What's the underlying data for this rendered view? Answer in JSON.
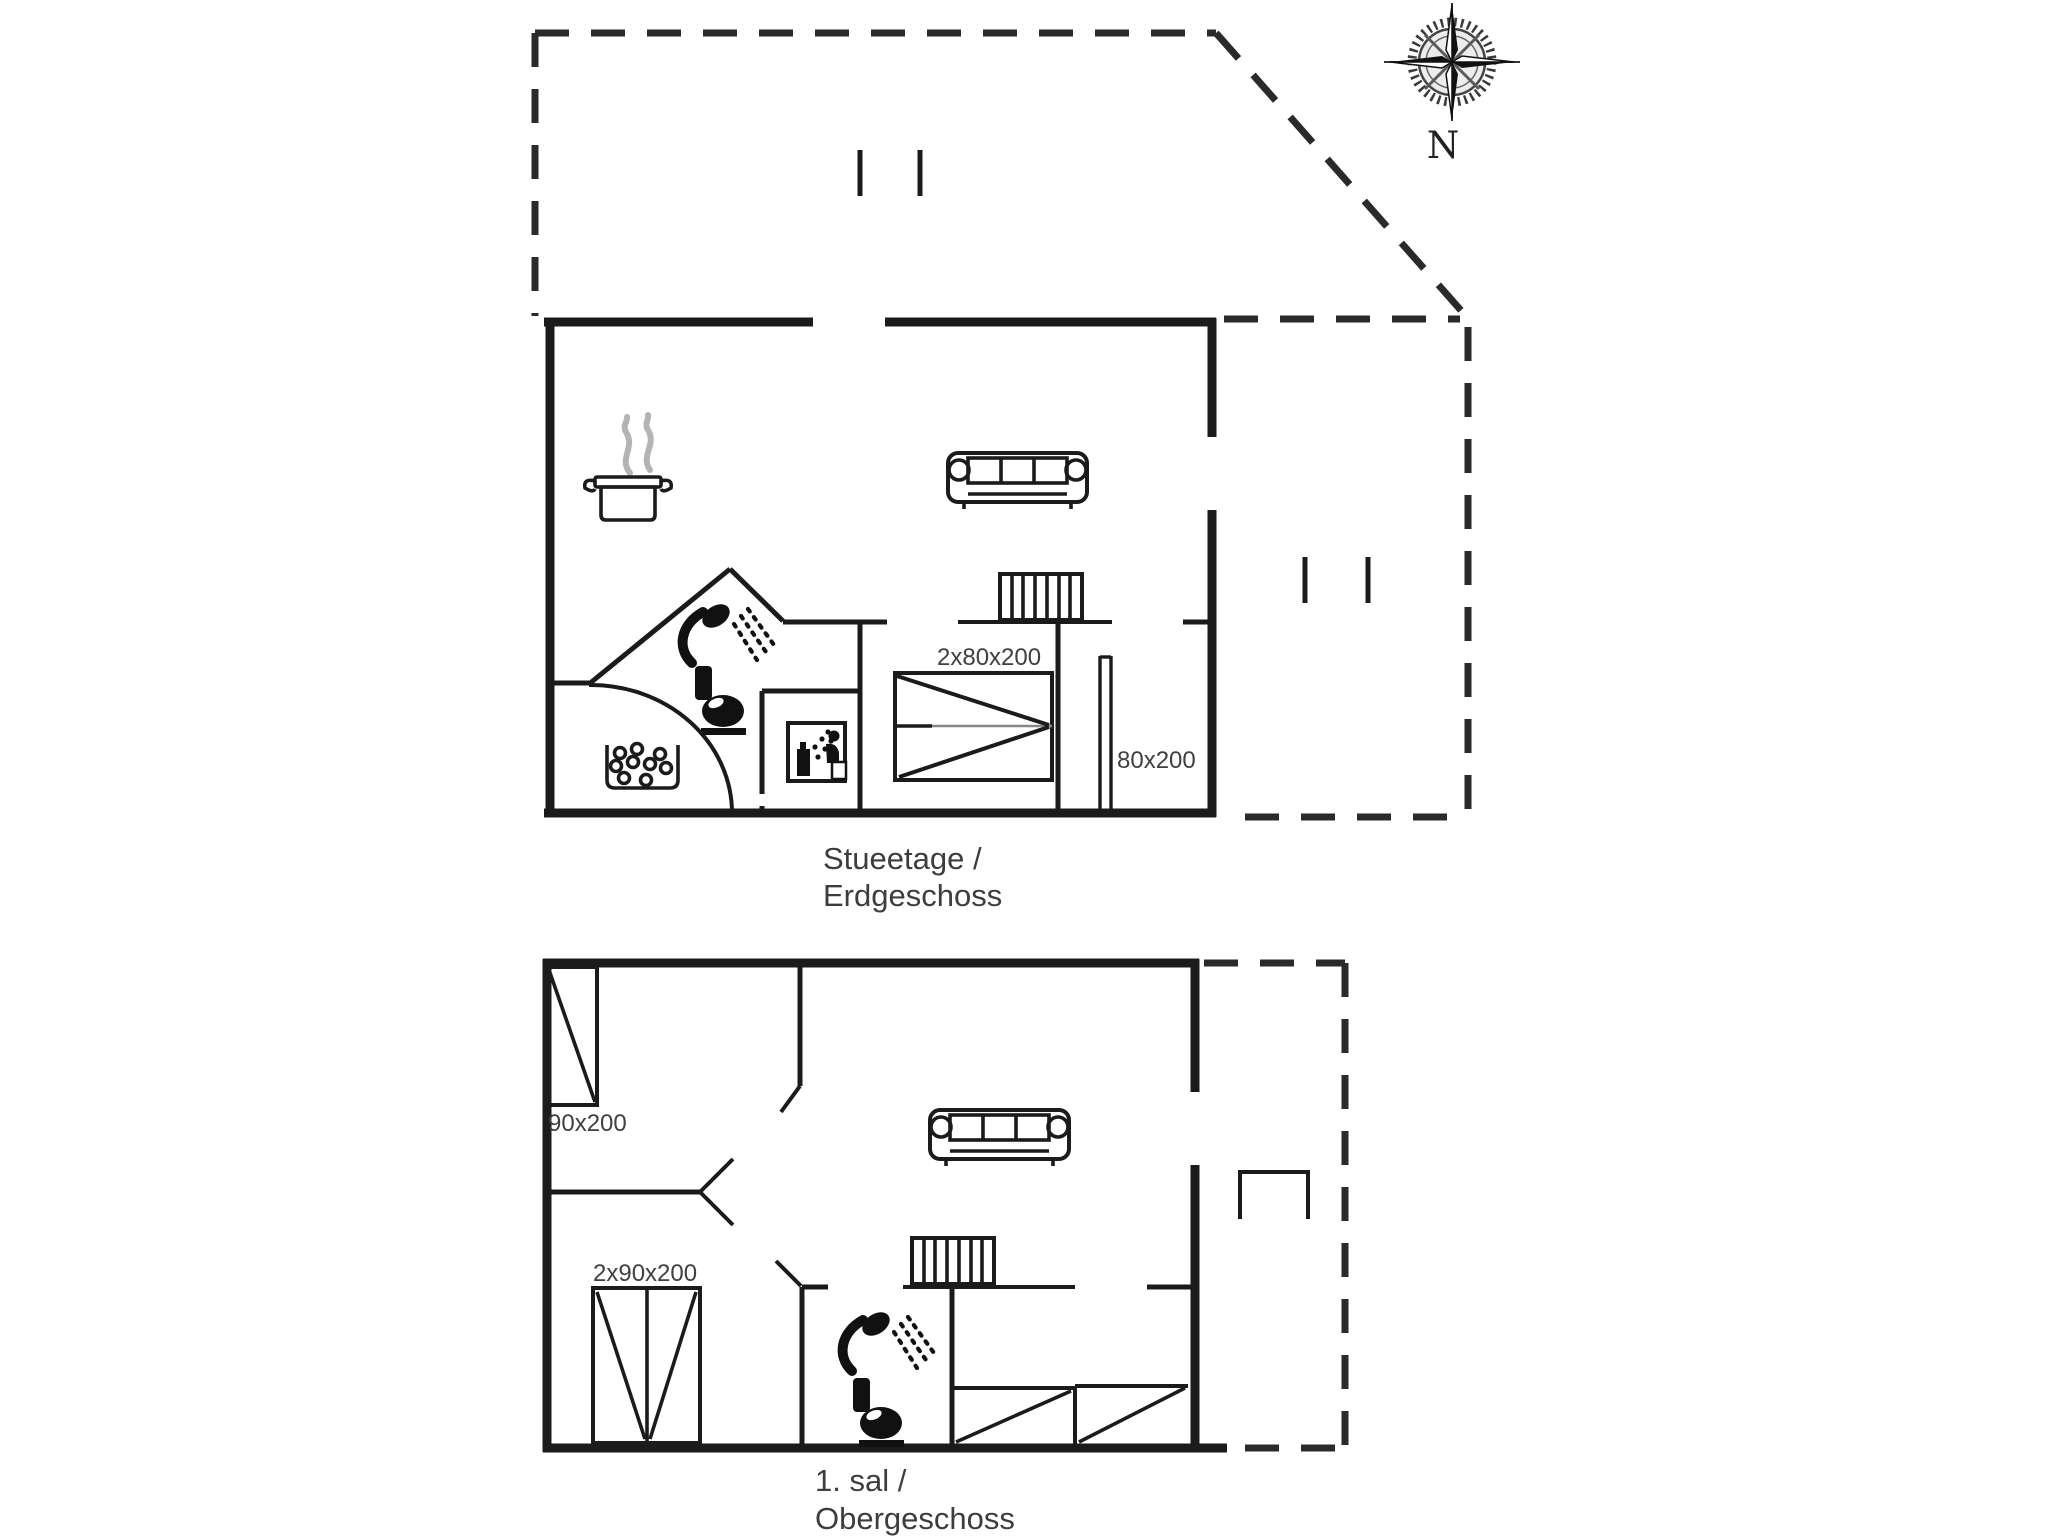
{
  "page": {
    "background": "#ffffff",
    "line_color": "#1b1b1b"
  },
  "compass": {
    "label": "N"
  },
  "ground_floor": {
    "caption_line1": "Stueetage /",
    "caption_line2": "Erdgeschoss",
    "double_bed_label": "2x80x200",
    "single_bed_label": "80x200"
  },
  "first_floor": {
    "caption_line1": "1. sal /",
    "caption_line2": "Obergeschoss",
    "single_bed_label": "90x200",
    "double_bed_label": "2x90x200"
  }
}
